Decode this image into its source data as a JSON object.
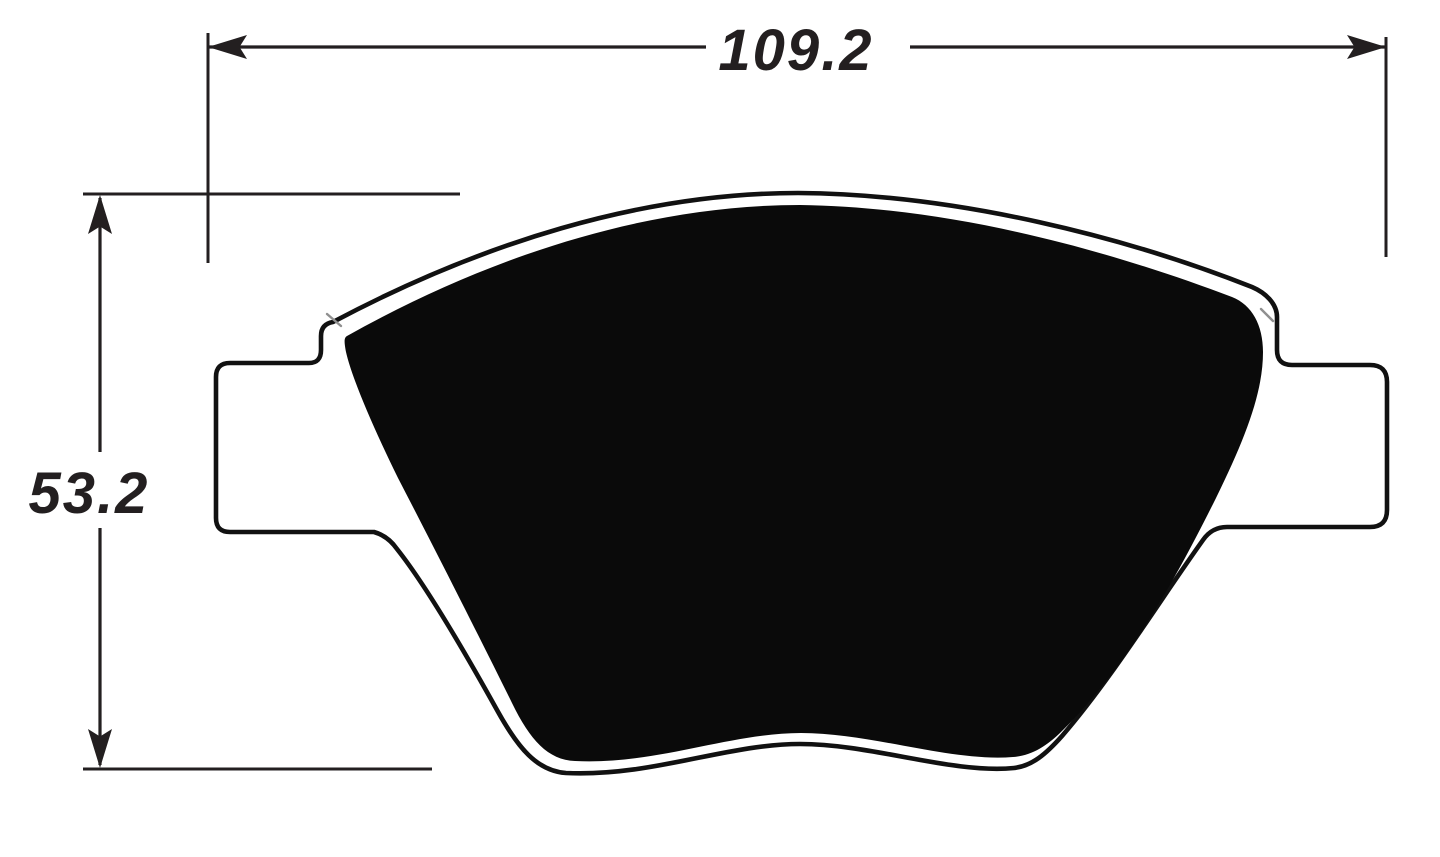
{
  "diagram": {
    "type": "technical-dimension-drawing",
    "part": "brake-pad-outline",
    "horizontal_dimension": {
      "value": "109.2"
    },
    "vertical_dimension": {
      "value": "53.2"
    }
  },
  "colors": {
    "line": "#231f20",
    "outline_stroke": "#111111",
    "pad_fill": "#0a0a0a",
    "tick_gray": "#8f8f8f",
    "background": "#ffffff"
  }
}
